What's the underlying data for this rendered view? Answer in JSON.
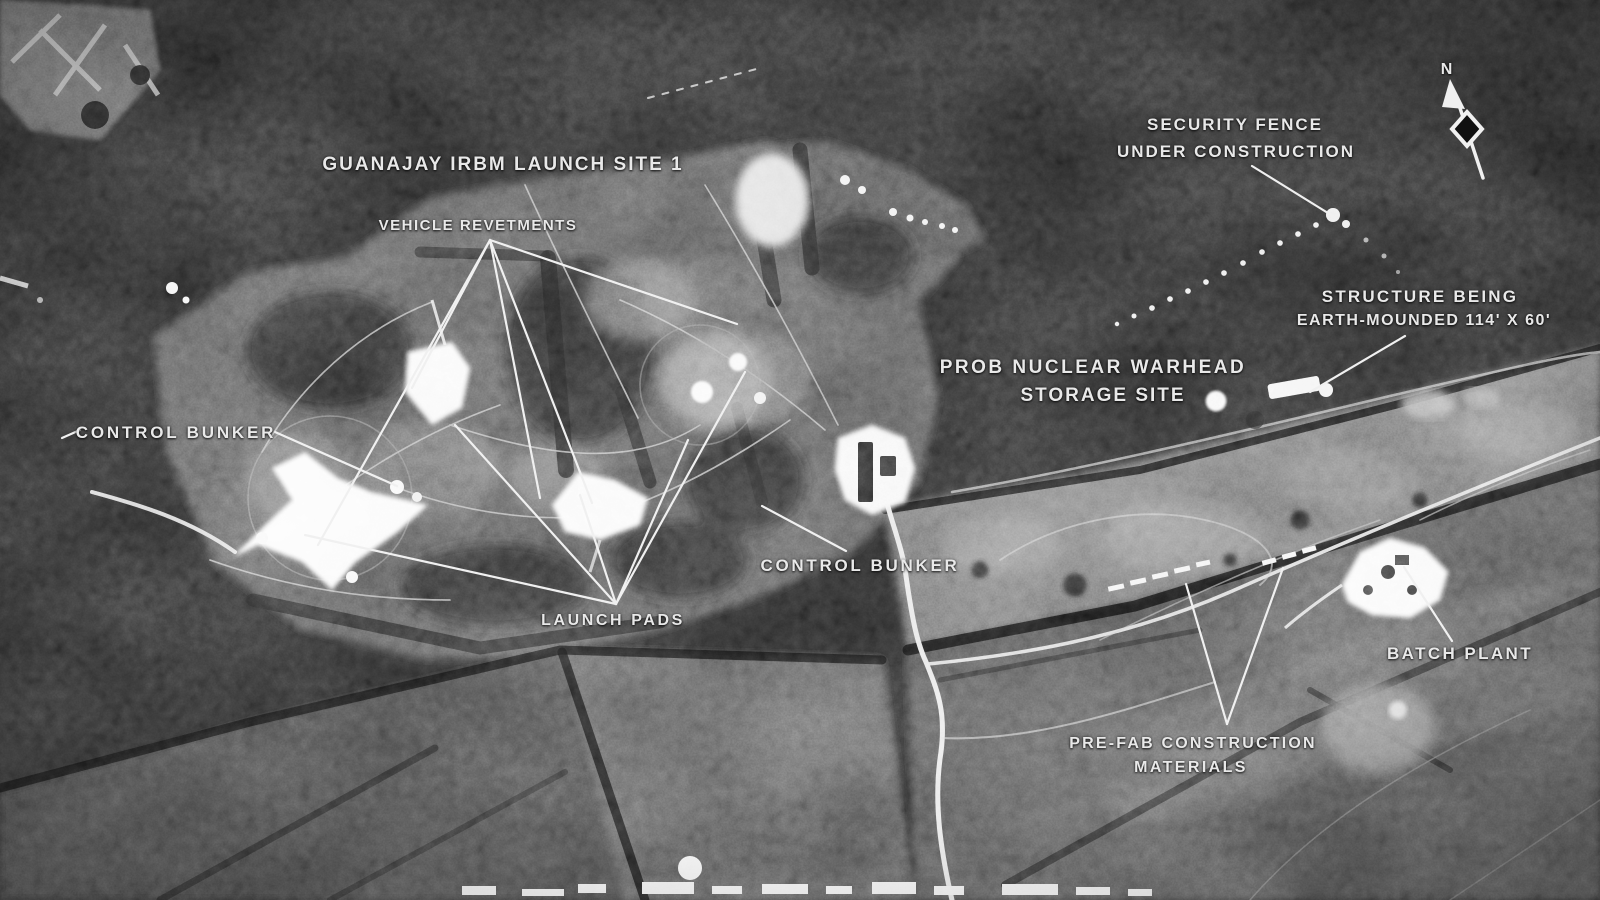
{
  "photo_meta": {
    "description": "black-and-white aerial reconnaissance photograph with intelligence annotations"
  },
  "annotations": {
    "site_title": {
      "lines": [
        "GUANAJAY IRBM LAUNCH SITE 1"
      ]
    },
    "vehicle_revetments": {
      "lines": [
        "VEHICLE REVETMENTS"
      ]
    },
    "security_fence": {
      "lines": [
        "SECURITY FENCE",
        "UNDER CONSTRUCTION"
      ]
    },
    "structure_earth_mounded": {
      "lines": [
        "STRUCTURE BEING",
        "EARTH-MOUNDED 114' X 60'"
      ]
    },
    "warhead_storage": {
      "lines": [
        "PROB NUCLEAR WARHEAD",
        "STORAGE SITE"
      ]
    },
    "control_bunker_left": {
      "lines": [
        "CONTROL BUNKER"
      ]
    },
    "control_bunker_center": {
      "lines": [
        "CONTROL BUNKER"
      ]
    },
    "launch_pads": {
      "lines": [
        "LAUNCH PADS"
      ]
    },
    "batch_plant": {
      "lines": [
        "BATCH PLANT"
      ]
    },
    "prefab_materials": {
      "lines": [
        "PRE-FAB CONSTRUCTION",
        "MATERIALS"
      ]
    },
    "north_arrow": {
      "label": "N"
    }
  },
  "colors": {
    "annotation_text": "#e9e9e9",
    "leader_line": "#f0f0f0",
    "photo_base": "#191919",
    "photo_highlight": "#f2f2f2"
  }
}
